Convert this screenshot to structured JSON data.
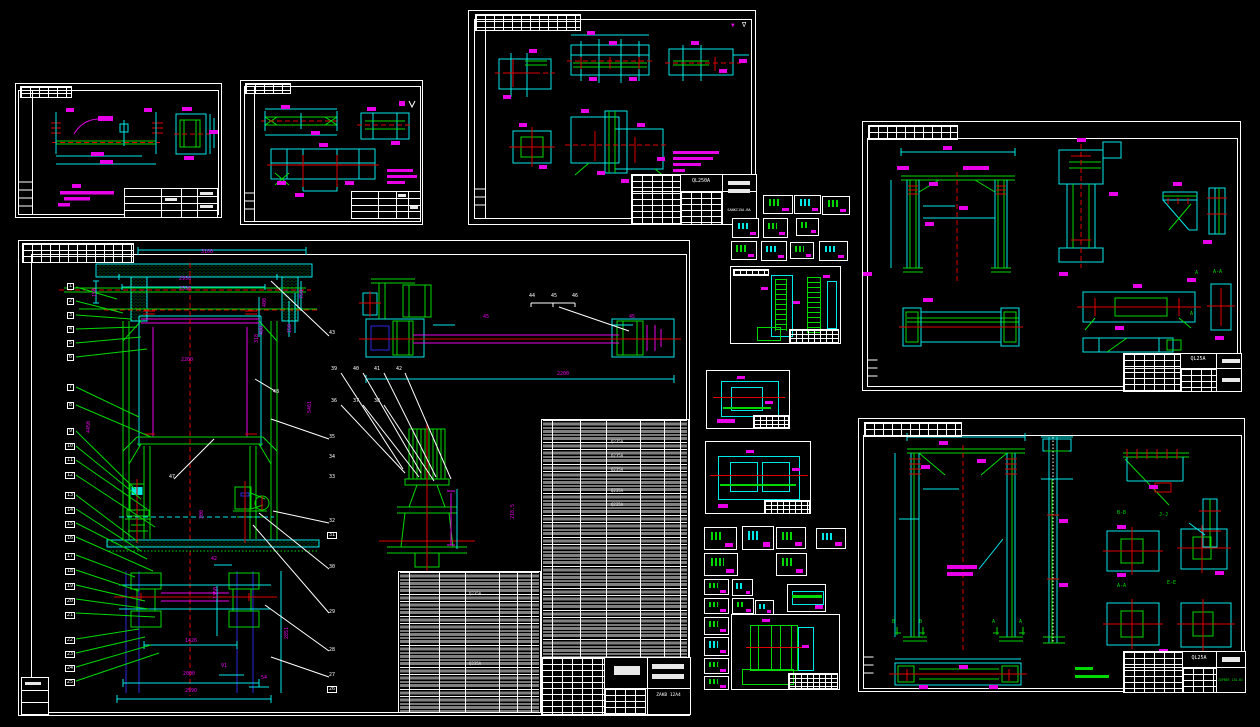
{
  "canvas": {
    "width": 1260,
    "height": 727,
    "background": "#000000"
  },
  "palette": {
    "line_green": "#00d900",
    "dim_cyan": "#00e8e8",
    "center_red": "#e00000",
    "dim_magenta": "#e800e8",
    "line_white": "#ffffff",
    "accent_blue": "#2a2ae0"
  },
  "sheets": {
    "top_center": {
      "title_code": "QL250A",
      "drawing_no": "SANKI15A-BA",
      "labels": [
        {
          "t": "▼",
          "x": 262,
          "y": 12,
          "c": "#e800e8",
          "n": "surface-finish-mark",
          "fs": 6
        },
        {
          "t": "∇",
          "x": 273,
          "y": 11,
          "c": "#ffffff",
          "n": "surface-finish-mark",
          "fs": 7
        }
      ]
    },
    "top_right": {
      "title_code": "QL25A",
      "labels": [
        {
          "t": "A-A",
          "x": 350,
          "y": 148,
          "n": "section-label"
        },
        {
          "t": "A",
          "x": 332,
          "y": 149,
          "n": "section-label"
        },
        {
          "t": "A",
          "x": 327,
          "y": 190,
          "n": "section-label"
        }
      ]
    },
    "main": {
      "drawing_no": "ZAKB 12A4",
      "material": "Q235A",
      "labels": [
        {
          "t": "1",
          "x": 48,
          "y": 42,
          "n": "balloon",
          "box": true
        },
        {
          "t": "2",
          "x": 48,
          "y": 57,
          "n": "balloon",
          "box": true
        },
        {
          "t": "3",
          "x": 48,
          "y": 71,
          "n": "balloon",
          "box": true
        },
        {
          "t": "4",
          "x": 48,
          "y": 85,
          "n": "balloon",
          "box": true
        },
        {
          "t": "5",
          "x": 48,
          "y": 99,
          "n": "balloon",
          "box": true
        },
        {
          "t": "6",
          "x": 48,
          "y": 113,
          "n": "balloon",
          "box": true
        },
        {
          "t": "7",
          "x": 48,
          "y": 143,
          "n": "balloon",
          "box": true
        },
        {
          "t": "8",
          "x": 48,
          "y": 161,
          "n": "balloon",
          "box": true
        },
        {
          "t": "9",
          "x": 48,
          "y": 187,
          "n": "balloon",
          "box": true
        },
        {
          "t": "10",
          "x": 46,
          "y": 202,
          "n": "balloon",
          "box": true
        },
        {
          "t": "11",
          "x": 46,
          "y": 216,
          "n": "balloon",
          "box": true
        },
        {
          "t": "12",
          "x": 46,
          "y": 231,
          "n": "balloon",
          "box": true
        },
        {
          "t": "13",
          "x": 46,
          "y": 251,
          "n": "balloon",
          "box": true
        },
        {
          "t": "14",
          "x": 46,
          "y": 266,
          "n": "balloon",
          "box": true
        },
        {
          "t": "15",
          "x": 46,
          "y": 280,
          "n": "balloon",
          "box": true
        },
        {
          "t": "16",
          "x": 46,
          "y": 294,
          "n": "balloon",
          "box": true
        },
        {
          "t": "17",
          "x": 46,
          "y": 312,
          "n": "balloon",
          "box": true
        },
        {
          "t": "18",
          "x": 46,
          "y": 327,
          "n": "balloon",
          "box": true
        },
        {
          "t": "19",
          "x": 46,
          "y": 342,
          "n": "balloon",
          "box": true
        },
        {
          "t": "20",
          "x": 46,
          "y": 357,
          "n": "balloon",
          "box": true
        },
        {
          "t": "21",
          "x": 46,
          "y": 371,
          "n": "balloon",
          "box": true
        },
        {
          "t": "22",
          "x": 46,
          "y": 396,
          "n": "balloon",
          "box": true
        },
        {
          "t": "23",
          "x": 46,
          "y": 410,
          "n": "balloon",
          "box": true
        },
        {
          "t": "24",
          "x": 46,
          "y": 424,
          "n": "balloon",
          "box": true
        },
        {
          "t": "25",
          "x": 46,
          "y": 438,
          "n": "balloon",
          "box": true
        },
        {
          "t": "31",
          "x": 308,
          "y": 291,
          "n": "balloon",
          "box": true
        },
        {
          "t": "26",
          "x": 308,
          "y": 445,
          "n": "balloon",
          "box": true
        },
        {
          "t": "43",
          "x": 310,
          "y": 90,
          "n": "callout"
        },
        {
          "t": "39",
          "x": 312,
          "y": 126,
          "n": "callout"
        },
        {
          "t": "40",
          "x": 334,
          "y": 126,
          "n": "callout"
        },
        {
          "t": "41",
          "x": 355,
          "y": 126,
          "n": "callout"
        },
        {
          "t": "42",
          "x": 377,
          "y": 126,
          "n": "callout"
        },
        {
          "t": "36",
          "x": 312,
          "y": 158,
          "n": "callout"
        },
        {
          "t": "37",
          "x": 334,
          "y": 158,
          "n": "callout"
        },
        {
          "t": "38",
          "x": 355,
          "y": 158,
          "n": "callout"
        },
        {
          "t": "35",
          "x": 310,
          "y": 194,
          "n": "callout"
        },
        {
          "t": "34",
          "x": 310,
          "y": 214,
          "n": "callout"
        },
        {
          "t": "33",
          "x": 310,
          "y": 234,
          "n": "callout"
        },
        {
          "t": "32",
          "x": 310,
          "y": 278,
          "n": "callout"
        },
        {
          "t": "30",
          "x": 310,
          "y": 324,
          "n": "callout"
        },
        {
          "t": "29",
          "x": 310,
          "y": 369,
          "n": "callout"
        },
        {
          "t": "28",
          "x": 310,
          "y": 407,
          "n": "callout"
        },
        {
          "t": "27",
          "x": 310,
          "y": 432,
          "n": "callout"
        },
        {
          "t": "47",
          "x": 150,
          "y": 234,
          "n": "callout"
        },
        {
          "t": "48",
          "x": 254,
          "y": 149,
          "n": "callout"
        },
        {
          "t": "44",
          "x": 510,
          "y": 53,
          "n": "callout"
        },
        {
          "t": "45",
          "x": 532,
          "y": 53,
          "n": "callout"
        },
        {
          "t": "46",
          "x": 553,
          "y": 53,
          "n": "callout"
        },
        {
          "t": "3100",
          "x": 182,
          "y": 9,
          "n": "dim"
        },
        {
          "t": "2950",
          "x": 160,
          "y": 36,
          "n": "dim"
        },
        {
          "t": "2530",
          "x": 160,
          "y": 46,
          "n": "dim"
        },
        {
          "t": "2200",
          "x": 162,
          "y": 117,
          "n": "dim"
        },
        {
          "t": "150",
          "x": 74,
          "y": 56,
          "r": -90,
          "n": "dim"
        },
        {
          "t": "750",
          "x": 281,
          "y": 58,
          "r": -90,
          "n": "dim"
        },
        {
          "t": "400",
          "x": 244,
          "y": 66,
          "r": -90,
          "n": "dim"
        },
        {
          "t": "400",
          "x": 241,
          "y": 94,
          "r": -90,
          "n": "dim"
        },
        {
          "t": "150",
          "x": 269,
          "y": 92,
          "r": -90,
          "n": "dim"
        },
        {
          "t": "318",
          "x": 236,
          "y": 102,
          "r": -90,
          "n": "dim"
        },
        {
          "t": "4450",
          "x": 68,
          "y": 192,
          "r": -90,
          "n": "dim"
        },
        {
          "t": "5461",
          "x": 289,
          "y": 172,
          "r": -90,
          "n": "dim"
        },
        {
          "t": "300",
          "x": 181,
          "y": 278,
          "r": -90,
          "n": "dim"
        },
        {
          "t": "42",
          "x": 192,
          "y": 316,
          "n": "dim"
        },
        {
          "t": "1350",
          "x": 195,
          "y": 358,
          "r": -90,
          "n": "dim"
        },
        {
          "t": "1426",
          "x": 166,
          "y": 398,
          "n": "dim"
        },
        {
          "t": "2851",
          "x": 266,
          "y": 398,
          "r": -90,
          "n": "dim"
        },
        {
          "t": "91",
          "x": 202,
          "y": 423,
          "n": "dim"
        },
        {
          "t": "2000",
          "x": 164,
          "y": 431,
          "n": "dim"
        },
        {
          "t": "54",
          "x": 242,
          "y": 435,
          "n": "dim"
        },
        {
          "t": "2590",
          "x": 166,
          "y": 448,
          "n": "dim"
        },
        {
          "t": "2200",
          "x": 538,
          "y": 131,
          "n": "dim"
        },
        {
          "t": "45",
          "x": 464,
          "y": 74,
          "n": "dim"
        },
        {
          "t": "45",
          "x": 610,
          "y": 74,
          "n": "dim"
        },
        {
          "t": "218.5",
          "x": 492,
          "y": 278,
          "r": -90,
          "n": "dim"
        },
        {
          "t": "Q235A",
          "x": 592,
          "y": 199,
          "n": "material-cell",
          "fs": 4
        },
        {
          "t": "Q235A",
          "x": 592,
          "y": 213,
          "n": "material-cell",
          "fs": 4
        },
        {
          "t": "Q235A",
          "x": 592,
          "y": 227,
          "n": "material-cell",
          "fs": 4
        },
        {
          "t": "Q235A",
          "x": 592,
          "y": 248,
          "n": "material-cell",
          "fs": 4
        },
        {
          "t": "Q235A",
          "x": 592,
          "y": 262,
          "n": "material-cell",
          "fs": 4
        },
        {
          "t": "Q235A",
          "x": 450,
          "y": 351,
          "n": "material-cell",
          "fs": 4
        },
        {
          "t": "Q235A",
          "x": 450,
          "y": 421,
          "n": "material-cell",
          "fs": 4
        }
      ]
    },
    "bottom_right": {
      "title_code": "QL25A",
      "drawing_no": "ZAPB03 12A-B1",
      "labels": [
        {
          "t": "B-B",
          "x": 258,
          "y": 92,
          "n": "section-label"
        },
        {
          "t": "J-J",
          "x": 300,
          "y": 94,
          "n": "section-label"
        },
        {
          "t": "A-A",
          "x": 258,
          "y": 165,
          "n": "section-label"
        },
        {
          "t": "E-E",
          "x": 308,
          "y": 162,
          "n": "section-label"
        },
        {
          "t": "B",
          "x": 33,
          "y": 201,
          "n": "section-label"
        },
        {
          "t": "B",
          "x": 60,
          "y": 201,
          "n": "section-label"
        },
        {
          "t": "A",
          "x": 133,
          "y": 201,
          "n": "section-label"
        },
        {
          "t": "A",
          "x": 160,
          "y": 201,
          "n": "section-label"
        }
      ]
    }
  }
}
